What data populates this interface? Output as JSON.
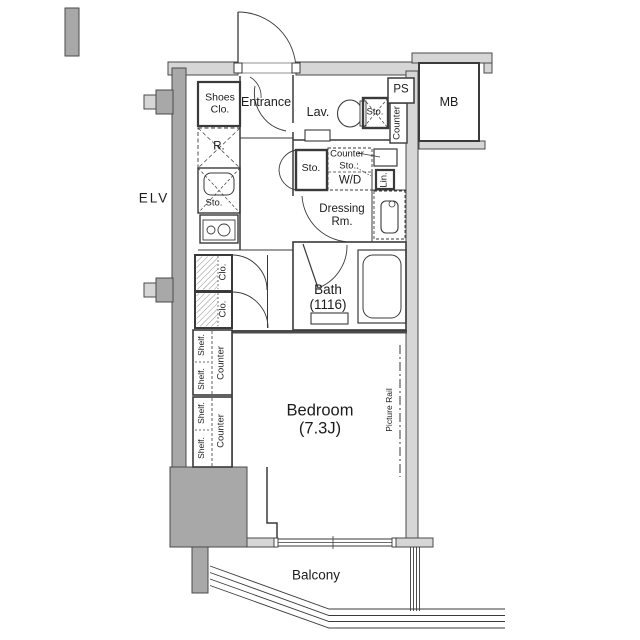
{
  "colors": {
    "wall_light": "#d6d6d6",
    "wall_dark": "#a8a8a8",
    "line": "#3a3a3a",
    "text": "#1c1c1c",
    "background": "#ffffff"
  },
  "labels": {
    "elv": "ELV",
    "entrance": "Entrance",
    "shoes_closet": "Shoes\nClo.",
    "refrigerator": "R.",
    "kitchen_storage": "Sto.",
    "lavatory": "Lav.",
    "toilet_storage": "Sto.",
    "pipe_space": "PS",
    "meter_box": "MB",
    "lav_counter": "Counter",
    "hall_storage": "Sto.",
    "counter_sto_counter": "Counter",
    "counter_sto_sto": "Sto.:",
    "washer_dryer": "W/D",
    "linen": "Lin.",
    "dressing_room": "Dressing\nRm.",
    "bath": "Bath\n(1116)",
    "closet_upper": "Clo.",
    "closet_lower": "Clo.",
    "shelf": "Shelf.",
    "counter_upper": "Counter",
    "counter_lower": "Counter",
    "bedroom": "Bedroom\n(7.3J)",
    "picture_rail": "Picture Rail",
    "balcony": "Balcony"
  }
}
